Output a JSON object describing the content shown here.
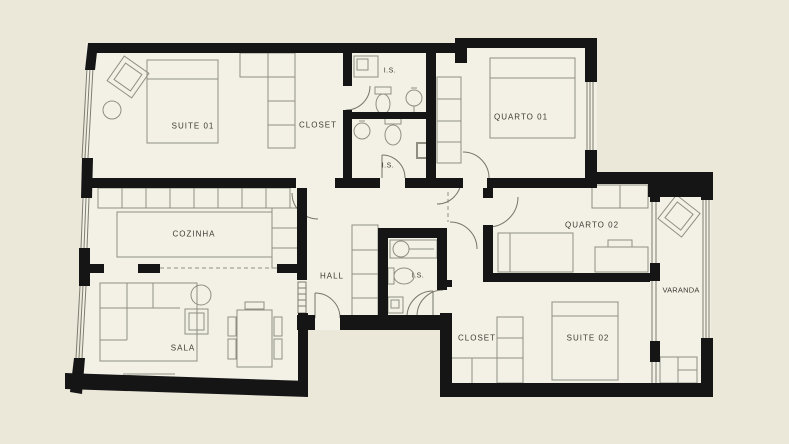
{
  "plan": {
    "title": "apartment-floor-plan",
    "rooms": [
      {
        "id": "suite-01",
        "label": "SUITE 01"
      },
      {
        "id": "closet-suite-01",
        "label": "CLOSET"
      },
      {
        "id": "is-1",
        "label": "I.S."
      },
      {
        "id": "quarto-01",
        "label": "QUARTO 01"
      },
      {
        "id": "is-2",
        "label": "I.S."
      },
      {
        "id": "cozinha",
        "label": "COZINHA"
      },
      {
        "id": "hall",
        "label": "HALL"
      },
      {
        "id": "is-3",
        "label": "I.S."
      },
      {
        "id": "quarto-02",
        "label": "QUARTO 02"
      },
      {
        "id": "varanda",
        "label": "VARANDA"
      },
      {
        "id": "sala",
        "label": "SALA"
      },
      {
        "id": "closet-suite-02",
        "label": "CLOSET"
      },
      {
        "id": "suite-02",
        "label": "SUITE 02"
      }
    ],
    "colors": {
      "background": "#ebe8da",
      "floor": "#f3f1e6",
      "wall": "#151515",
      "furniture_line": "#8f8e81",
      "door_arc": "#76756a",
      "text": "#3c3b34"
    }
  }
}
